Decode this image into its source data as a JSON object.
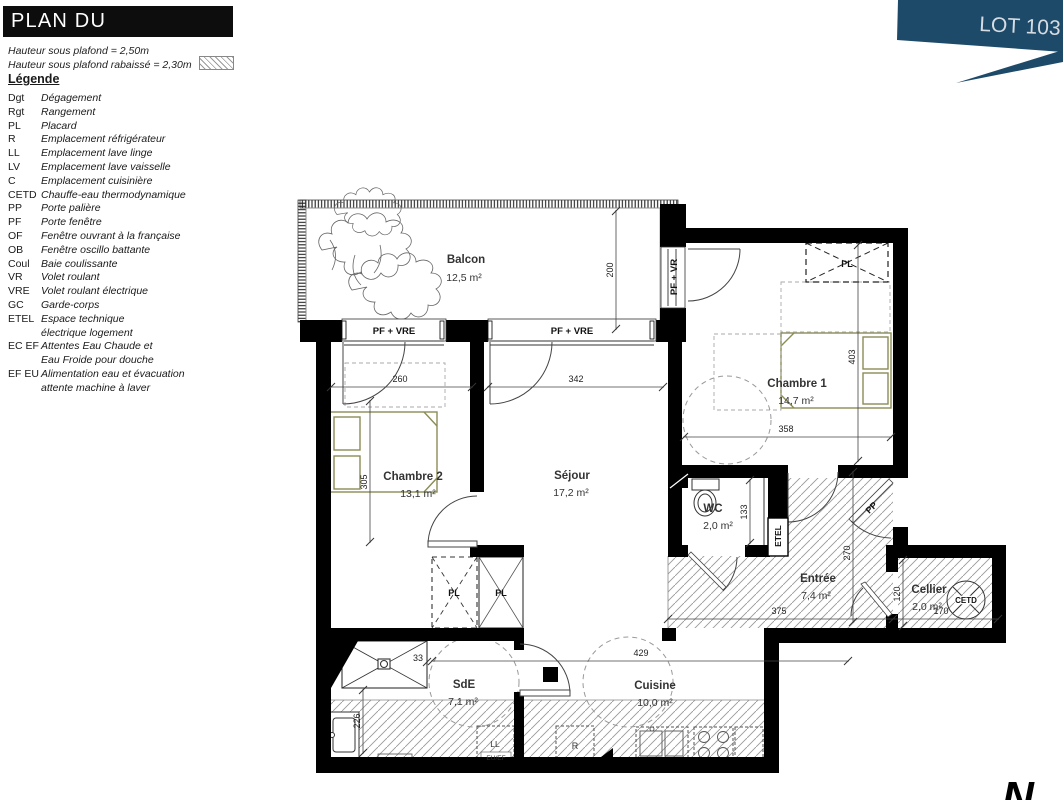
{
  "header": {
    "title": "PLAN DU LOGEMENT",
    "lot": "LOT 103",
    "ceiling_note_1": "Hauteur sous plafond = 2,50m",
    "ceiling_note_2": "Hauteur sous plafond rabaissé = 2,30m",
    "legend_title": "Légende"
  },
  "legend": {
    "items": [
      {
        "abbr": "Dgt",
        "label": "Dégagement"
      },
      {
        "abbr": "Rgt",
        "label": "Rangement"
      },
      {
        "abbr": "PL",
        "label": "Placard"
      },
      {
        "abbr": "R",
        "label": "Emplacement réfrigérateur"
      },
      {
        "abbr": "LL",
        "label": "Emplacement lave linge"
      },
      {
        "abbr": "LV",
        "label": "Emplacement lave vaisselle"
      },
      {
        "abbr": "C",
        "label": "Emplacement cuisinière"
      },
      {
        "abbr": "CETD",
        "label": "Chauffe-eau thermodynamique"
      },
      {
        "abbr": "PP",
        "label": "Porte palière"
      },
      {
        "abbr": "PF",
        "label": "Porte fenêtre"
      },
      {
        "abbr": "OF",
        "label": "Fenêtre ouvrant à la française"
      },
      {
        "abbr": "OB",
        "label": "Fenêtre oscillo battante"
      },
      {
        "abbr": "Coul",
        "label": "Baie coulissante"
      },
      {
        "abbr": "VR",
        "label": "Volet roulant"
      },
      {
        "abbr": "VRE",
        "label": "Volet roulant électrique"
      },
      {
        "abbr": "GC",
        "label": "Garde-corps"
      },
      {
        "abbr": "ETEL",
        "label": "Espace technique",
        "label2": "électrique logement"
      },
      {
        "abbr": "EC EF",
        "label": "Attentes Eau Chaude et",
        "label2": "Eau Froide pour douche"
      },
      {
        "abbr": "EF EU",
        "label": "Alimentation eau et évacuation",
        "label2": "attente machine à laver"
      }
    ]
  },
  "plan": {
    "rooms": {
      "balcon": {
        "name": "Balcon",
        "area": "12,5 m²"
      },
      "chambre1": {
        "name": "Chambre 1",
        "area": "14,7 m²"
      },
      "chambre2": {
        "name": "Chambre 2",
        "area": "13,1 m²"
      },
      "sejour": {
        "name": "Séjour",
        "area": "17,2 m²"
      },
      "wc": {
        "name": "WC",
        "area": "2,0 m²"
      },
      "entree": {
        "name": "Entrée",
        "area": "7,4 m²"
      },
      "cellier": {
        "name": "Cellier",
        "area": "2,0 m²"
      },
      "sde": {
        "name": "SdE",
        "area": "7,1 m²"
      },
      "cuisine": {
        "name": "Cuisine",
        "area": "10,0 m²"
      }
    },
    "windows": {
      "pf_vre_left": "PF + VRE",
      "pf_vre_right": "PF + VRE",
      "pf_vr": "PF + VR"
    },
    "features": {
      "pl_chambre1": "PL",
      "pl_closet_left": "PL",
      "pl_closet_right": "PL",
      "etel": "ETEL",
      "pp": "PP",
      "cetd": "CETD",
      "ll": "LL",
      "r": "R",
      "eu_ef": "EU/EF",
      "north": "N"
    },
    "dimensions": {
      "balcon_depth": "200",
      "chambre2_window": "260",
      "sejour_window": "342",
      "chambre1_depth": "403",
      "chambre1_width": "358",
      "chambre2_depth": "305",
      "wc_depth": "133",
      "entree_depth": "270",
      "entree_width": "375",
      "cellier_depth": "120",
      "cellier_width": "170",
      "cuisine_width": "429",
      "shower_width": "33",
      "sde_depth": "226"
    }
  },
  "colors": {
    "banner": "#1e4a69",
    "banner_text": "#d6dce2",
    "wall": "#000000",
    "bed_outline": "#8c8c55",
    "hatch": "#999999",
    "dim_line": "#444444"
  }
}
